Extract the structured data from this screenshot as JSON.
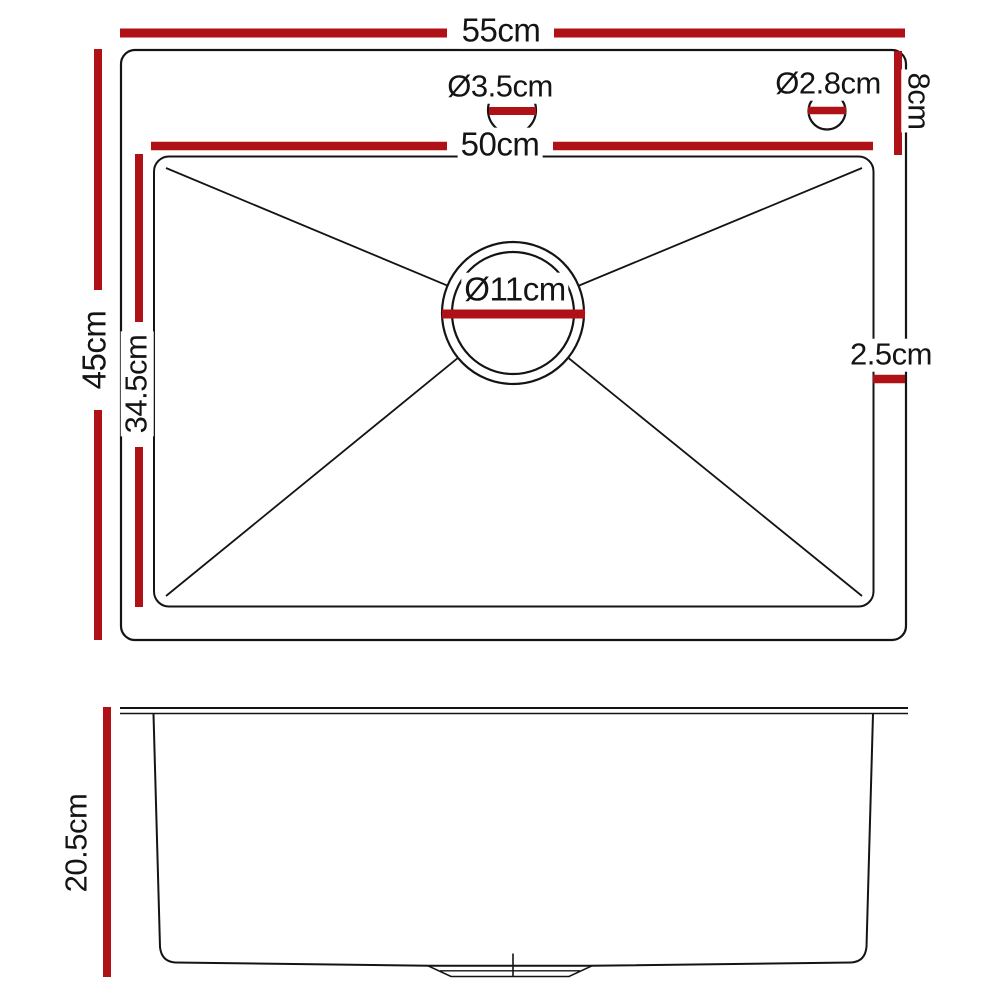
{
  "colors": {
    "dimension_red": "#b01116",
    "line_black": "#141414",
    "background": "#ffffff"
  },
  "top_view": {
    "overall_width": "55cm",
    "overall_depth": "45cm",
    "bowl_width": "50cm",
    "bowl_depth": "34.5cm",
    "left_tap_hole_diameter": "Ø3.5cm",
    "right_tap_hole_diameter": "Ø2.8cm",
    "top_deck_depth": "8cm",
    "side_rim_width": "2.5cm",
    "drain_diameter": "Ø11cm"
  },
  "side_view": {
    "bowl_height": "20.5cm"
  }
}
